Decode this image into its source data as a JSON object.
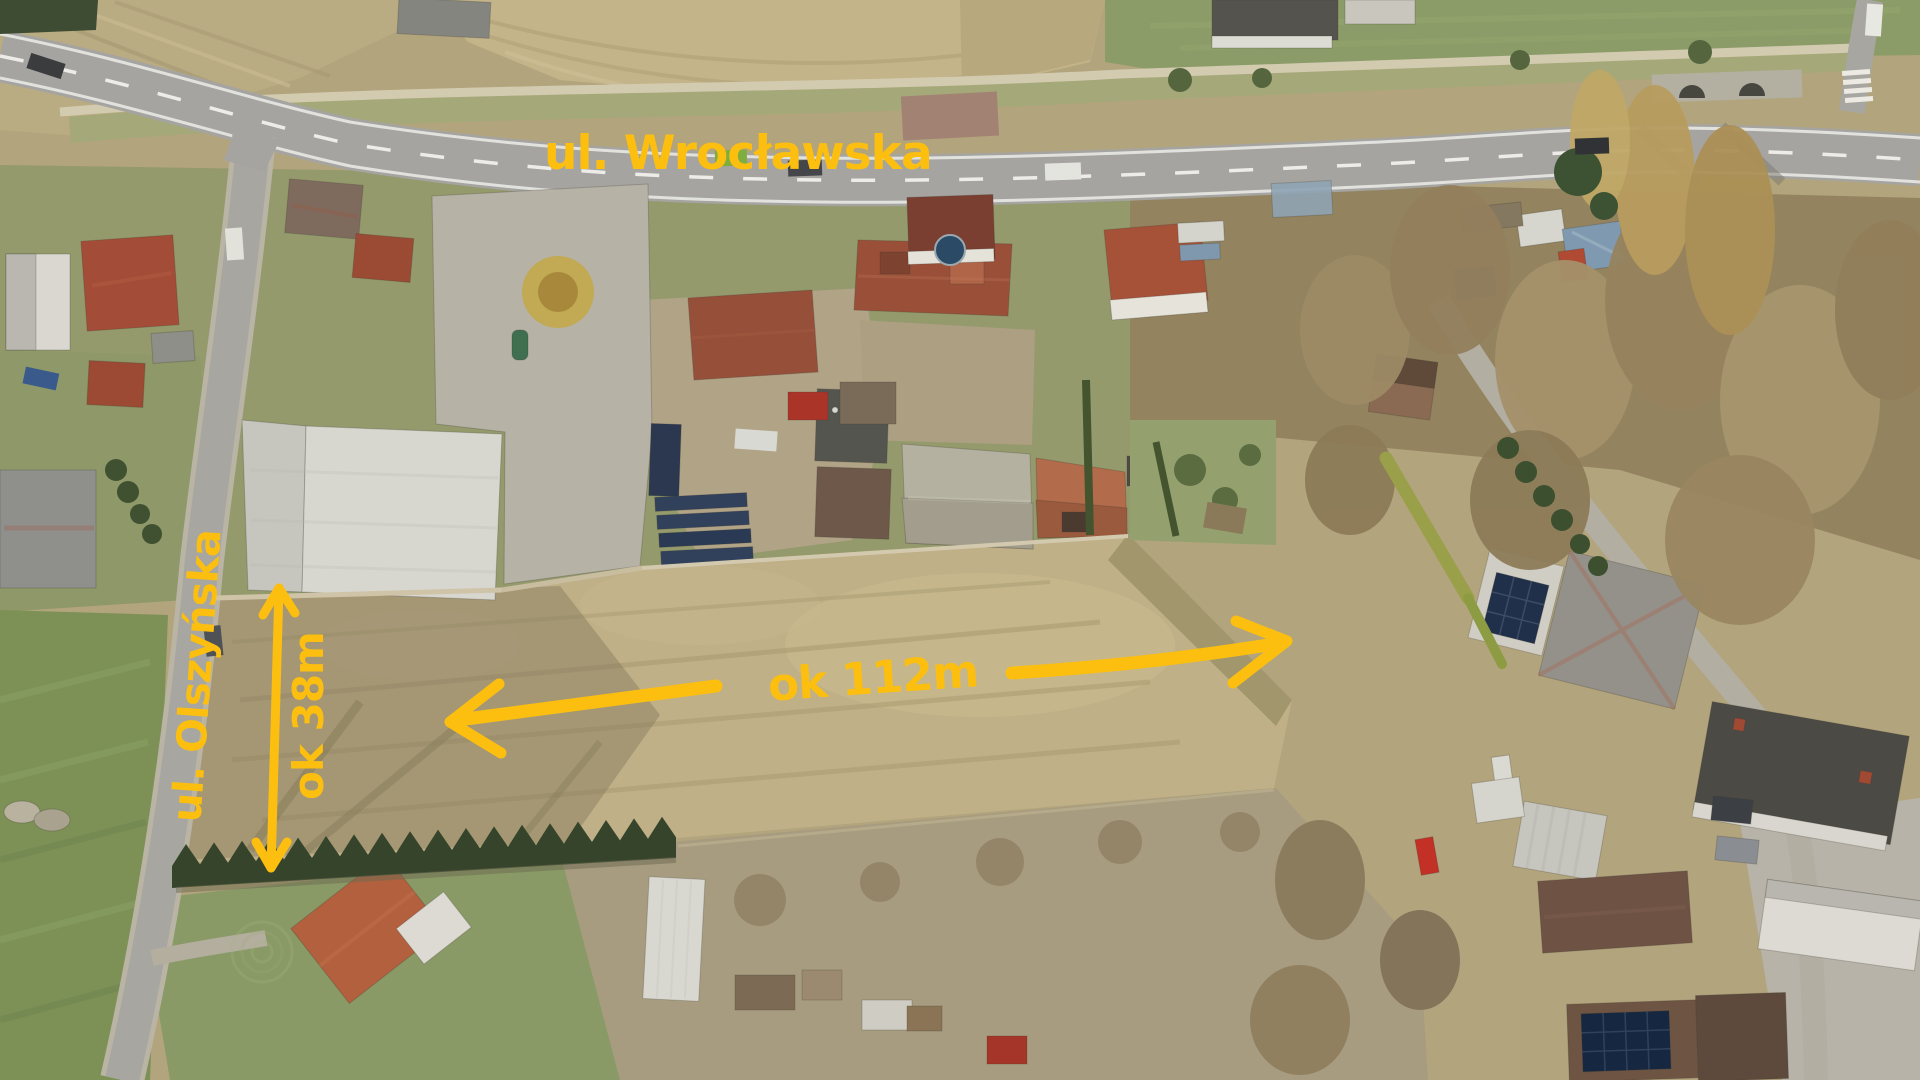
{
  "annotations": {
    "color": "#FCBF10",
    "street_top": {
      "label": "ul. Wrocławska"
    },
    "street_left": {
      "label": "ul. Olszyńska"
    },
    "width_dimension": {
      "label": "ok 38m"
    },
    "length_dimension": {
      "label": "ok 112m"
    }
  }
}
